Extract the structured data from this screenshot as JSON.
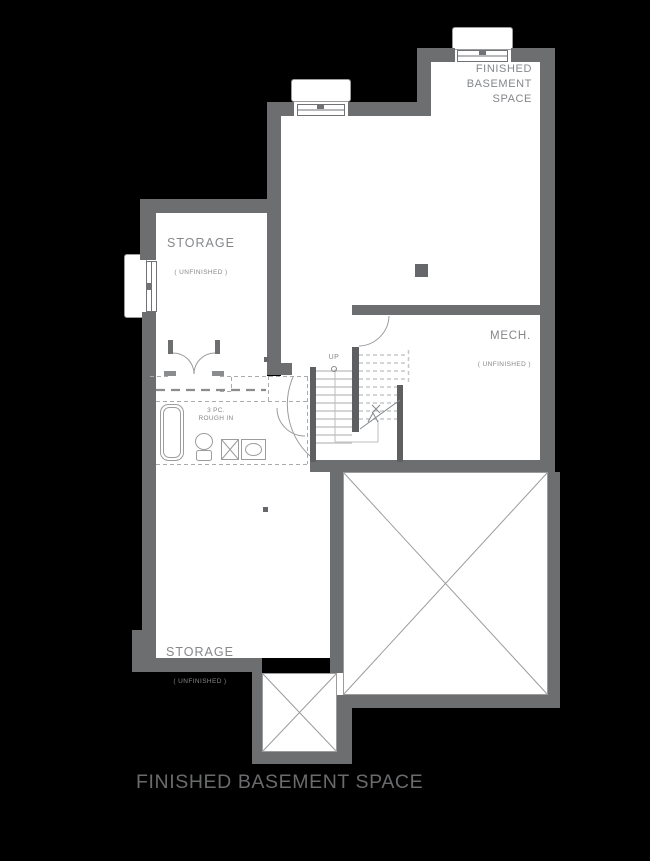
{
  "plan_title": "FINISHED BASEMENT SPACE",
  "rooms": {
    "finished_basement": {
      "label": "FINISHED\nBASEMENT\nSPACE"
    },
    "storage_top": {
      "label": "STORAGE",
      "sublabel": "( UNFINISHED )"
    },
    "storage_bottom": {
      "label": "STORAGE",
      "sublabel": "( UNFINISHED )"
    },
    "mech": {
      "label": "MECH.",
      "sublabel": "( UNFINISHED )"
    },
    "bath_rough_in": {
      "label": "3 PC.\nROUGH IN"
    },
    "stairs": {
      "direction_label": "UP"
    }
  },
  "colors": {
    "bg": "#000000",
    "floor": "#ffffff",
    "wall": "#6d6e70",
    "stairwall": "#5e5f61",
    "line": "#9b9c9e",
    "tread": "#c6c7c8",
    "dash": "#a9abad",
    "dark": "#66676a",
    "text": "#85878a",
    "title": "#6a6b6d"
  }
}
